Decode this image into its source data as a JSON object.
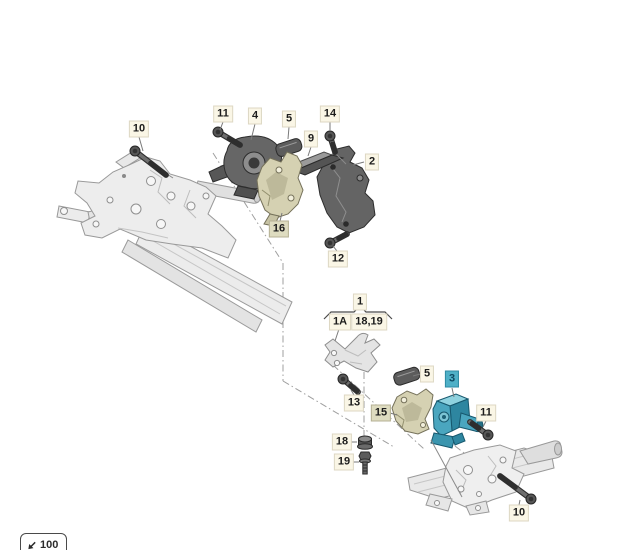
{
  "page": {
    "background": "#ffffff"
  },
  "diagram": {
    "type": "exploded-parts-diagram",
    "selected_part": "3",
    "group_highlighted_parts": [
      "15",
      "16"
    ],
    "group_bracket": {
      "parent_label": "1",
      "child_left": "1A",
      "child_right": "18,19"
    },
    "callouts": [
      {
        "id": "10-top",
        "label": "10",
        "x": 139,
        "y": 129,
        "style": "normal",
        "leader": [
          139,
          137,
          143,
          151
        ]
      },
      {
        "id": "11-top",
        "label": "11",
        "x": 223,
        "y": 114,
        "style": "normal",
        "leader": [
          223,
          122,
          220,
          130
        ]
      },
      {
        "id": "4",
        "label": "4",
        "x": 255,
        "y": 116,
        "style": "normal",
        "leader": [
          255,
          124,
          251,
          140
        ]
      },
      {
        "id": "5-top",
        "label": "5",
        "x": 289,
        "y": 119,
        "style": "normal",
        "leader": [
          289,
          127,
          288,
          139
        ]
      },
      {
        "id": "14",
        "label": "14",
        "x": 330,
        "y": 114,
        "style": "normal",
        "leader": [
          330,
          122,
          330,
          131
        ]
      },
      {
        "id": "9",
        "label": "9",
        "x": 311,
        "y": 139,
        "style": "normal",
        "leader": [
          311,
          147,
          308,
          156
        ]
      },
      {
        "id": "2",
        "label": "2",
        "x": 372,
        "y": 162,
        "style": "normal",
        "leader": [
          364,
          162,
          353,
          165
        ]
      },
      {
        "id": "16",
        "label": "16",
        "x": 279,
        "y": 229,
        "style": "tan",
        "leader": [
          280,
          221,
          282,
          213
        ]
      },
      {
        "id": "12",
        "label": "12",
        "x": 338,
        "y": 259,
        "style": "normal",
        "leader": [
          337,
          251,
          333,
          246
        ]
      },
      {
        "id": "1",
        "label": "1",
        "x": 360,
        "y": 302,
        "style": "normal",
        "leader": null
      },
      {
        "id": "1A",
        "label": "1A",
        "x": 340,
        "y": 322,
        "style": "normal",
        "leader": [
          339,
          329,
          335,
          341
        ]
      },
      {
        "id": "18-19",
        "label": "18,19",
        "x": 369,
        "y": 322,
        "style": "normal",
        "leader": null
      },
      {
        "id": "13",
        "label": "13",
        "x": 354,
        "y": 403,
        "style": "normal",
        "leader": [
          354,
          395,
          351,
          390
        ]
      },
      {
        "id": "5-bottom",
        "label": "5",
        "x": 427,
        "y": 374,
        "style": "normal",
        "leader": [
          420,
          374,
          413,
          376
        ]
      },
      {
        "id": "15",
        "label": "15",
        "x": 381,
        "y": 413,
        "style": "tan",
        "leader": [
          390,
          413,
          397,
          415
        ]
      },
      {
        "id": "3",
        "label": "3",
        "x": 452,
        "y": 379,
        "style": "selected",
        "leader": [
          452,
          388,
          454,
          397
        ]
      },
      {
        "id": "11-bottom",
        "label": "11",
        "x": 486,
        "y": 413,
        "style": "normal",
        "leader": [
          486,
          421,
          483,
          427
        ]
      },
      {
        "id": "18",
        "label": "18",
        "x": 342,
        "y": 442,
        "style": "normal",
        "leader": [
          350,
          442,
          357,
          442
        ]
      },
      {
        "id": "19",
        "label": "19",
        "x": 344,
        "y": 462,
        "style": "normal",
        "leader": [
          351,
          462,
          359,
          462
        ]
      },
      {
        "id": "10-bottom",
        "label": "10",
        "x": 519,
        "y": 513,
        "style": "normal",
        "leader": [
          519,
          505,
          520,
          500
        ]
      }
    ]
  },
  "scale_button": {
    "label": "100",
    "icon": "scale-arrow-icon"
  },
  "colors": {
    "label_background": "#faf6e6",
    "label_text": "#1c1c1c",
    "group_highlight_background": "#dedcc0",
    "selected_highlight_background": "#4fb0c7",
    "selected_highlight_text": "#0d4a63",
    "selected_part_fill": "#4aa6bf",
    "highlighted_part_fill": "#d5d1b2"
  }
}
